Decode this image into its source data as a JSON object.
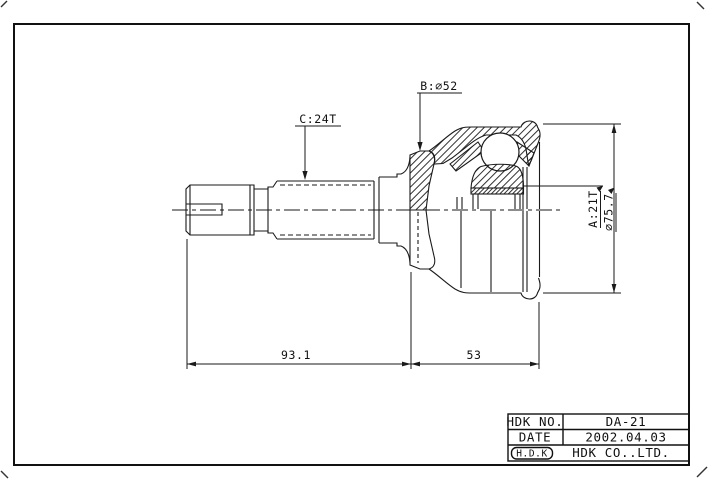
{
  "annotations": {
    "b_label": "B:∅52",
    "c_label": "C:24T",
    "a_label": "A:21T",
    "dia_label": "∅75.7"
  },
  "dimensions": {
    "length_left": "93.1",
    "length_right": "53"
  },
  "title_block": {
    "rows": [
      {
        "label": "HDK NO.",
        "value": "DA-21"
      },
      {
        "label": "DATE",
        "value": "2002.04.03"
      }
    ],
    "logo": "H.D.K",
    "company": "HDK CO..LTD."
  }
}
